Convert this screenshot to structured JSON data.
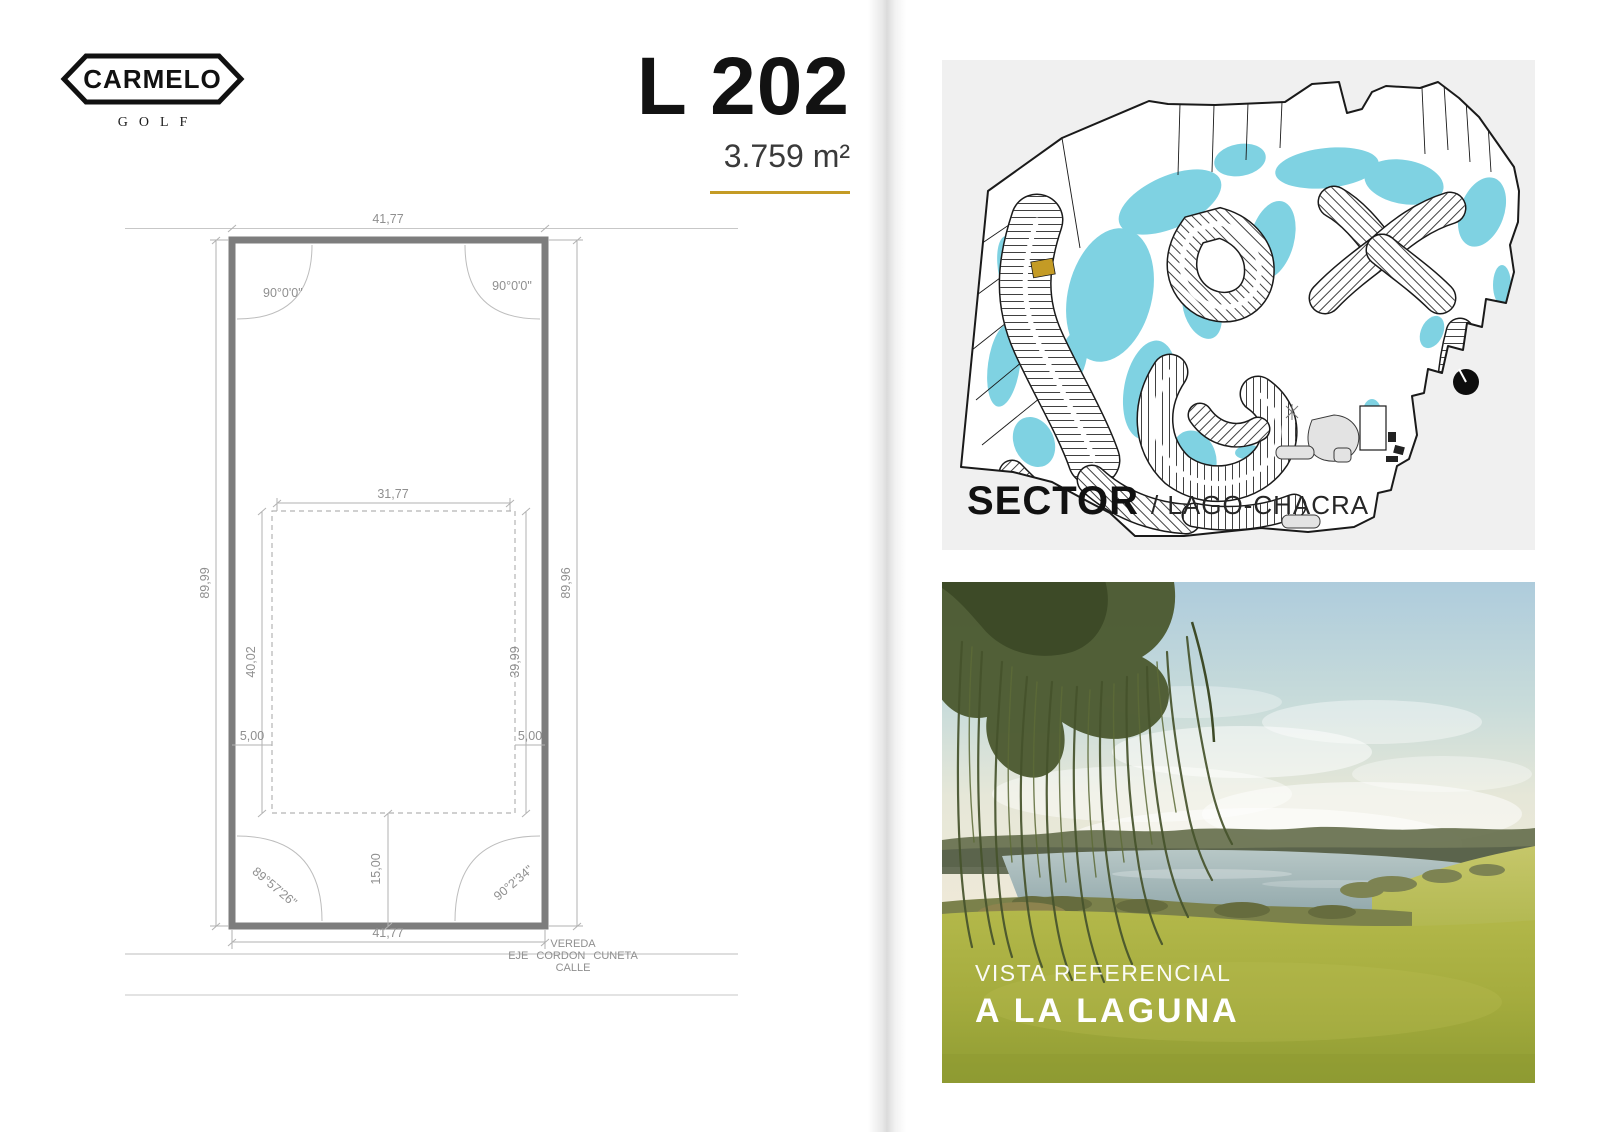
{
  "logo": {
    "brand": "CARMELO",
    "sub": "GOLF"
  },
  "title": {
    "lot": "L 202",
    "area": "3.759 m²"
  },
  "colors": {
    "accent": "#c49b25",
    "lake": "#7fd2e2",
    "plan_gray": "#7d7d7d"
  },
  "plan": {
    "dims": {
      "front_top": "41,77",
      "front_bottom": "41,77",
      "side_left": "89,99",
      "side_right": "89,96",
      "inner_top": "31,77",
      "inner_left": "40,02",
      "inner_right": "39,99",
      "setback_left": "5,00",
      "setback_right": "5,00",
      "setback_front": "15,00"
    },
    "angles": {
      "top_left": "90°0'0\"",
      "top_right": "90°0'0\"",
      "bottom_left": "89°57'26\"",
      "bottom_right": "90°2'34\""
    },
    "street": {
      "vereda": "VEREDA",
      "eje": "EJE CORDON CUNETA",
      "calle": "CALLE"
    }
  },
  "sector": {
    "label": "SECTOR",
    "value": "/ LAGO-CHACRA"
  },
  "photo": {
    "caption_line1": "VISTA REFERENCIAL",
    "caption_line2": "A LA LAGUNA"
  }
}
